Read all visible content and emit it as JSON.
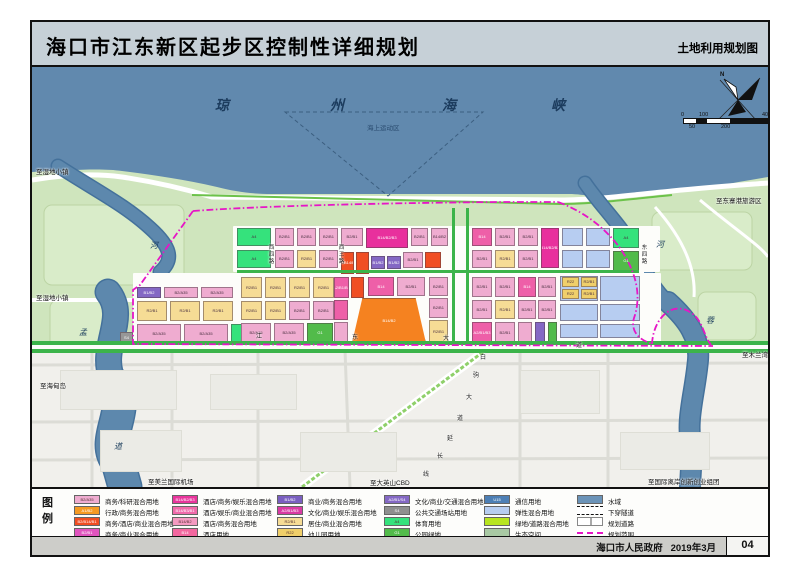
{
  "title": {
    "main": "海口市江东新区起步区控制性详细规划",
    "right": "土地利用规划图"
  },
  "footer": {
    "government": "海口市人民政府",
    "date": "2019年3月",
    "page": "04"
  },
  "colors": {
    "sea": "#6189ae",
    "land": "#cfe5bd",
    "urban": "#f1f0ec",
    "boundary": "#e616c6",
    "road_green": "#3cb44a",
    "river": "#5d88ad"
  },
  "map": {
    "sea_chars": [
      {
        "t": "琼",
        "x": 215,
        "y": 95
      },
      {
        "t": "州",
        "x": 330,
        "y": 95
      },
      {
        "t": "海",
        "x": 442,
        "y": 95
      },
      {
        "t": "峡",
        "x": 551,
        "y": 95
      }
    ],
    "marine_zone_label": {
      "t": "海上运动区",
      "x": 367,
      "y": 122
    },
    "river_chars": [
      {
        "t": "河",
        "x": 150,
        "y": 240
      },
      {
        "t": "孟",
        "x": 79,
        "y": 327
      },
      {
        "t": "道",
        "x": 114,
        "y": 441
      },
      {
        "t": "河",
        "x": 656,
        "y": 239
      },
      {
        "t": "蓉",
        "x": 706,
        "y": 315
      }
    ],
    "edge_labels": [
      {
        "t": "至湿地小镇",
        "x": 36,
        "y": 166
      },
      {
        "t": "至湿地小镇",
        "x": 36,
        "y": 292
      },
      {
        "t": "至海甸岛",
        "x": 40,
        "y": 380
      },
      {
        "t": "至东寨港旅游区",
        "x": 716,
        "y": 195
      },
      {
        "t": "至木兰湾",
        "x": 742,
        "y": 349
      },
      {
        "t": "至美兰国际机场",
        "x": 148,
        "y": 476
      },
      {
        "t": "至大英山CBD",
        "x": 370,
        "y": 477
      },
      {
        "t": "至国际离岸创新创业组团",
        "x": 648,
        "y": 476
      }
    ],
    "h_road_chars": [
      {
        "t": "江",
        "x": 256,
        "y": 331
      },
      {
        "t": "东",
        "x": 352,
        "y": 332
      },
      {
        "t": "大",
        "x": 443,
        "y": 333
      },
      {
        "t": "道",
        "x": 576,
        "y": 340
      }
    ],
    "diag_road_chars": [
      {
        "t": "白",
        "x": 480,
        "y": 352
      },
      {
        "t": "驹",
        "x": 473,
        "y": 370
      },
      {
        "t": "大",
        "x": 466,
        "y": 392
      },
      {
        "t": "道",
        "x": 457,
        "y": 413
      },
      {
        "t": "延",
        "x": 447,
        "y": 433
      },
      {
        "t": "长",
        "x": 437,
        "y": 451
      },
      {
        "t": "线",
        "x": 423,
        "y": 469
      }
    ],
    "v_roads": [
      {
        "chars": [
          "西",
          "四",
          "路"
        ],
        "x": 268,
        "y": 245
      },
      {
        "chars": [
          "西",
          "三",
          "路"
        ],
        "x": 338,
        "y": 245
      },
      {
        "chars": [
          "东",
          "四",
          "路"
        ],
        "x": 641,
        "y": 245
      }
    ],
    "compass_label": "N",
    "scale": {
      "top": [
        {
          "t": "0",
          "x": 681
        },
        {
          "t": "100",
          "x": 699
        },
        {
          "t": "400m",
          "x": 762
        }
      ],
      "bottom": [
        {
          "t": "50",
          "x": 689
        },
        {
          "t": "200",
          "x": 721
        }
      ]
    },
    "blocks": [
      [
        237,
        228,
        34,
        18,
        "bg",
        "A4"
      ],
      [
        237,
        250,
        34,
        18,
        "bg",
        "A4"
      ],
      [
        275,
        228,
        19,
        18,
        "pk",
        "B2/B1"
      ],
      [
        297,
        228,
        19,
        18,
        "pk",
        "B2/B1"
      ],
      [
        319,
        228,
        19,
        18,
        "pk",
        "B2/B1"
      ],
      [
        341,
        228,
        22,
        18,
        "pk",
        "B2/B1"
      ],
      [
        366,
        228,
        42,
        20,
        "mg",
        "B14/B2/B3"
      ],
      [
        411,
        228,
        17,
        18,
        "pk",
        "B2/B1"
      ],
      [
        431,
        228,
        17,
        18,
        "pk",
        "B14/B2"
      ],
      [
        472,
        228,
        20,
        18,
        "ro",
        "B14"
      ],
      [
        495,
        228,
        20,
        18,
        "pk",
        "B2/B1"
      ],
      [
        518,
        228,
        20,
        18,
        "pk",
        "B2/B1"
      ],
      [
        541,
        228,
        18,
        40,
        "mg",
        "B14/B2/B3"
      ],
      [
        562,
        228,
        21,
        18,
        "lb",
        ""
      ],
      [
        586,
        228,
        24,
        18,
        "lb",
        ""
      ],
      [
        613,
        228,
        26,
        20,
        "bg",
        "A4"
      ],
      [
        613,
        251,
        26,
        20,
        "gn",
        "G1"
      ],
      [
        275,
        250,
        19,
        18,
        "pk",
        "B2/B1"
      ],
      [
        297,
        250,
        19,
        18,
        "yl",
        "R2/B1"
      ],
      [
        319,
        250,
        19,
        18,
        "pk",
        "B2/B1"
      ],
      [
        341,
        252,
        13,
        22,
        "rd",
        "B2/B14/B1"
      ],
      [
        356,
        252,
        13,
        22,
        "rd",
        ""
      ],
      [
        371,
        256,
        14,
        13,
        "pu",
        "B1/B2"
      ],
      [
        387,
        256,
        14,
        13,
        "pu",
        "B1/B2"
      ],
      [
        403,
        252,
        20,
        16,
        "pk",
        "B2/B1"
      ],
      [
        425,
        252,
        16,
        16,
        "rd",
        ""
      ],
      [
        472,
        250,
        20,
        18,
        "pk",
        "B2/B1"
      ],
      [
        495,
        250,
        20,
        18,
        "yl",
        "R2/B1"
      ],
      [
        518,
        250,
        20,
        18,
        "pk",
        "B2/B1"
      ],
      [
        562,
        250,
        21,
        18,
        "lb",
        ""
      ],
      [
        586,
        250,
        24,
        18,
        "lb",
        ""
      ],
      [
        137,
        287,
        24,
        11,
        "pu",
        "B1/B2"
      ],
      [
        164,
        287,
        34,
        11,
        "pk",
        "B2/A35"
      ],
      [
        201,
        287,
        32,
        11,
        "pk",
        "B2/A35"
      ],
      [
        137,
        301,
        30,
        20,
        "yl",
        "R2/B1"
      ],
      [
        170,
        301,
        30,
        20,
        "yl",
        "R2/B1"
      ],
      [
        203,
        301,
        30,
        20,
        "yl",
        "R2/B1"
      ],
      [
        137,
        324,
        44,
        19,
        "pk",
        "B2/A35"
      ],
      [
        184,
        324,
        44,
        19,
        "pk",
        "B2/A35"
      ],
      [
        231,
        324,
        28,
        19,
        "bg",
        "A4"
      ],
      [
        120,
        332,
        13,
        12,
        "gy",
        "S4"
      ],
      [
        241,
        277,
        21,
        21,
        "yl",
        "R2/B1"
      ],
      [
        265,
        277,
        21,
        21,
        "yl",
        "R2/B1"
      ],
      [
        289,
        277,
        21,
        21,
        "yl",
        "R2/B1"
      ],
      [
        313,
        277,
        21,
        21,
        "yl",
        "R2/B1"
      ],
      [
        241,
        301,
        21,
        19,
        "yl",
        "R2/B1"
      ],
      [
        265,
        301,
        21,
        19,
        "yl",
        "R2/B1"
      ],
      [
        289,
        301,
        21,
        19,
        "pk",
        "B2/B1"
      ],
      [
        313,
        301,
        21,
        19,
        "pk",
        "B2/B1"
      ],
      [
        241,
        323,
        30,
        20,
        "pk",
        "B2/A35"
      ],
      [
        274,
        323,
        30,
        20,
        "pk",
        "B2/A35"
      ],
      [
        307,
        323,
        26,
        20,
        "gn",
        "G1"
      ],
      [
        334,
        277,
        15,
        21,
        "ro",
        "A2/B1/B3"
      ],
      [
        351,
        277,
        13,
        21,
        "rd",
        ""
      ],
      [
        368,
        277,
        26,
        19,
        "ro",
        "B14"
      ],
      [
        397,
        277,
        28,
        19,
        "pk",
        "B2/B1"
      ],
      [
        334,
        300,
        14,
        20,
        "ro",
        ""
      ],
      [
        334,
        322,
        14,
        21,
        "pk",
        ""
      ],
      [
        429,
        277,
        19,
        19,
        "pk",
        "B2/B1"
      ],
      [
        429,
        298,
        19,
        20,
        "pk",
        "B2/B1"
      ],
      [
        429,
        320,
        19,
        23,
        "yl",
        "R2/B1"
      ],
      [
        352,
        298,
        74,
        45,
        "or",
        "B14/B2"
      ],
      [
        472,
        277,
        20,
        20,
        "pk",
        "B2/B1"
      ],
      [
        495,
        277,
        20,
        20,
        "pk",
        "B2/B1"
      ],
      [
        518,
        277,
        18,
        20,
        "ro",
        "B14"
      ],
      [
        538,
        277,
        18,
        20,
        "pk",
        "B2/B1"
      ],
      [
        472,
        300,
        20,
        19,
        "pk",
        "B2/B1"
      ],
      [
        495,
        300,
        20,
        19,
        "yl",
        "R2/B1"
      ],
      [
        518,
        300,
        18,
        19,
        "pk",
        "B2/B1"
      ],
      [
        538,
        300,
        18,
        19,
        "pk",
        "B2/B1"
      ],
      [
        472,
        322,
        20,
        21,
        "ro",
        "A2/B1/B3"
      ],
      [
        495,
        322,
        20,
        21,
        "pk",
        "B2/B1"
      ],
      [
        518,
        322,
        14,
        21,
        "pk",
        ""
      ],
      [
        535,
        322,
        10,
        21,
        "pu",
        ""
      ],
      [
        548,
        322,
        9,
        21,
        "gn",
        "G1"
      ],
      [
        560,
        276,
        38,
        25,
        "lb",
        ""
      ],
      [
        600,
        276,
        40,
        25,
        "lb",
        ""
      ],
      [
        560,
        304,
        38,
        17,
        "lb",
        ""
      ],
      [
        600,
        304,
        40,
        17,
        "lb",
        ""
      ],
      [
        560,
        324,
        38,
        14,
        "lb",
        ""
      ],
      [
        600,
        324,
        40,
        14,
        "lb",
        ""
      ],
      [
        562,
        277,
        17,
        10,
        "ys",
        "R22"
      ],
      [
        581,
        277,
        16,
        10,
        "ys",
        "R2/B1"
      ],
      [
        562,
        289,
        17,
        10,
        "ys",
        "R22"
      ],
      [
        581,
        289,
        16,
        10,
        "ys",
        "R2/B1"
      ]
    ]
  },
  "legend": {
    "title_chars": [
      "图",
      "例"
    ],
    "columns": [
      {
        "x": 42,
        "items": [
          {
            "code": "B2/A35",
            "color": "#efacd0",
            "dark": true,
            "label": "商务/科研混合用地"
          },
          {
            "code": "A1/B2",
            "color": "#f59a23",
            "dark": false,
            "label": "行政/商务混合用地"
          },
          {
            "code": "B2/B14/B1",
            "color": "#f04e23",
            "dark": false,
            "label": "商务/酒店/商业混合用地"
          },
          {
            "code": "B2/B1",
            "color": "#e054be",
            "dark": false,
            "label": "商务/商业混合用地"
          }
        ]
      },
      {
        "x": 140,
        "items": [
          {
            "code": "B14/B2/B3",
            "color": "#e8359c",
            "dark": false,
            "label": "酒店/商务/娱乐混合用地"
          },
          {
            "code": "B14/B3/B1",
            "color": "#f06aab",
            "dark": false,
            "label": "酒店/娱乐/商业混合用地"
          },
          {
            "code": "B14/B2",
            "color": "#f49ac1",
            "dark": true,
            "label": "酒店/商务混合用地"
          },
          {
            "code": "B14",
            "color": "#f2679f",
            "dark": false,
            "label": "酒店用地"
          }
        ]
      },
      {
        "x": 245,
        "items": [
          {
            "code": "B1/B2",
            "color": "#7a5fc0",
            "dark": false,
            "label": "商业/商务混合用地"
          },
          {
            "code": "A2/B1/B3",
            "color": "#d93aa4",
            "dark": false,
            "label": "文化/商业/娱乐混合用地"
          },
          {
            "code": "R2/B1",
            "color": "#f6dc95",
            "dark": true,
            "label": "居住/商业混合用地"
          },
          {
            "code": "R22",
            "color": "#f0cf6a",
            "dark": true,
            "label": "幼儿园用地"
          }
        ]
      },
      {
        "x": 352,
        "items": [
          {
            "code": "A2/B1/S4",
            "color": "#8468c4",
            "dark": false,
            "label": "文化/商业/交通混合用地"
          },
          {
            "code": "S4",
            "color": "#8f8f8f",
            "dark": false,
            "label": "公共交通场站用地"
          },
          {
            "code": "A4",
            "color": "#35e27c",
            "dark": true,
            "label": "体育用地"
          },
          {
            "code": "G1",
            "color": "#52bb4a",
            "dark": false,
            "label": "公园绿地"
          }
        ]
      },
      {
        "x": 452,
        "items": [
          {
            "code": "U15",
            "color": "#4d7fb5",
            "dark": false,
            "label": "通信用地"
          },
          {
            "code": "",
            "color": "#b7cdf1",
            "dark": true,
            "label": "弹性混合用地"
          },
          {
            "code": "",
            "color": "#b8e520",
            "dark": true,
            "label": "绿地/道路混合用地"
          },
          {
            "code": "",
            "color": "#a9c9a4",
            "dark": true,
            "label": "生态空间"
          }
        ]
      },
      {
        "x": 545,
        "items": [
          {
            "type": "water",
            "color": "#6b93b8",
            "label": "水域"
          },
          {
            "type": "tunnel",
            "label": "下穿隧道"
          },
          {
            "type": "road",
            "label": "规划道路"
          },
          {
            "type": "boundary",
            "color": "#e616c6",
            "label": "规划范围"
          }
        ]
      }
    ]
  }
}
